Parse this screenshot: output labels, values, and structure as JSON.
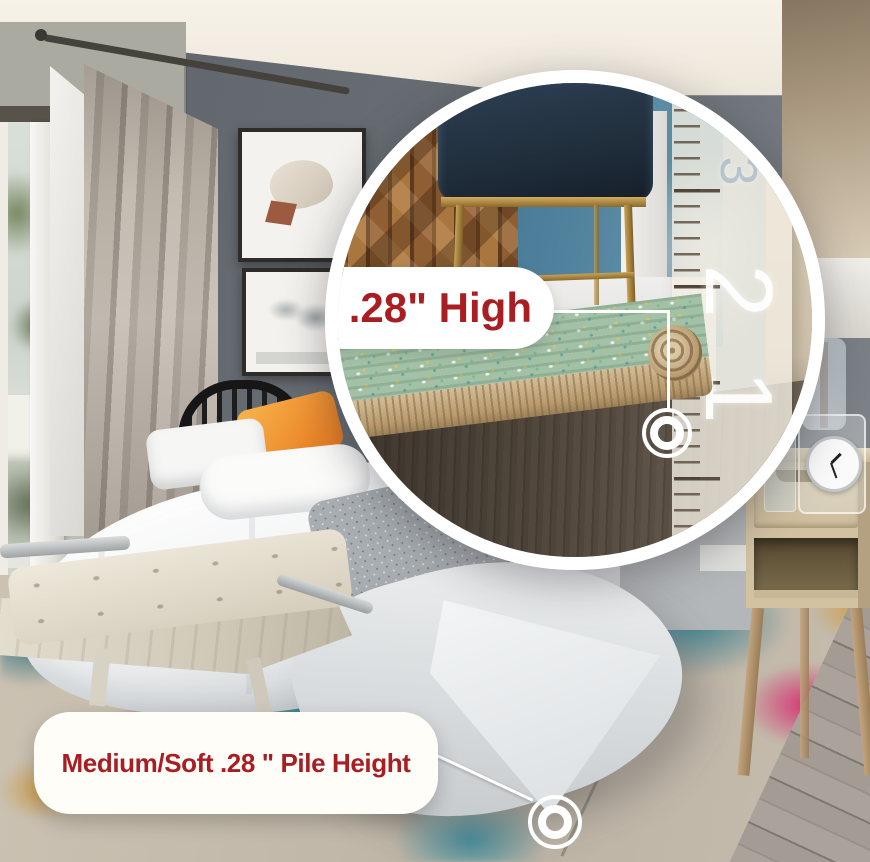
{
  "labels": {
    "zoom_callout": ".28\" High",
    "pile_callout": "Medium/Soft .28 \" Pile Height"
  },
  "ruler": {
    "numbers": [
      "3",
      "2",
      "1"
    ]
  },
  "icons": {
    "zoom_target": "target-ring-icon",
    "pile_target": "target-ring-icon",
    "magnifier": "magnifier-circle"
  },
  "colors": {
    "accent_red": "#a81e23",
    "callout_background": "#ffffff",
    "magnifier_ring": "#ffffff",
    "leader_line": "#ffffff"
  }
}
